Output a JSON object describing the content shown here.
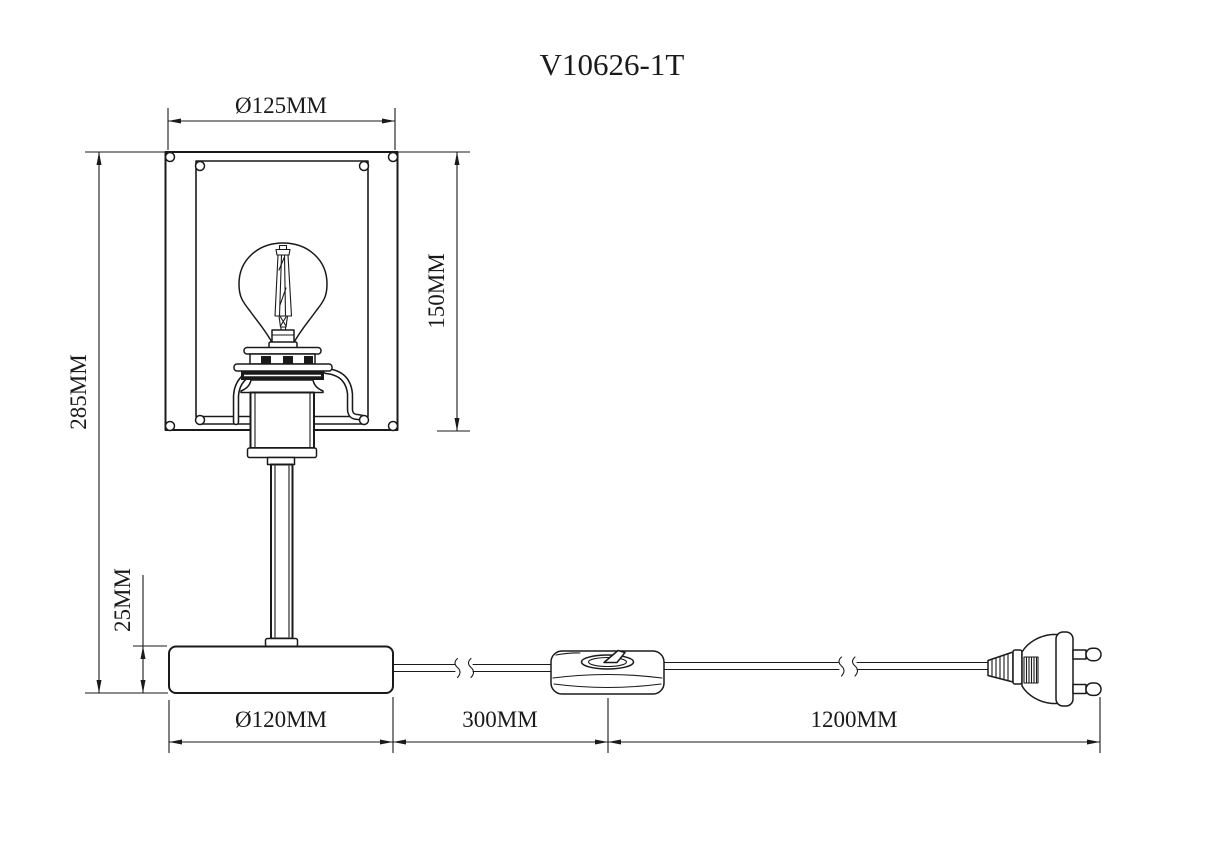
{
  "title": "V10626-1T",
  "drawing": {
    "object": "table-lamp-dimension-drawing",
    "line_color": "#1a1a1a",
    "background_color": "#ffffff"
  },
  "dimensions": {
    "shade_diameter": {
      "label": "Ø125MM",
      "value_mm": 125,
      "axis": "horizontal"
    },
    "shade_height": {
      "label": "150MM",
      "value_mm": 150,
      "axis": "vertical"
    },
    "total_height": {
      "label": "285MM",
      "value_mm": 285,
      "axis": "vertical"
    },
    "base_height": {
      "label": "25MM",
      "value_mm": 25,
      "axis": "vertical"
    },
    "base_diameter": {
      "label": "Ø120MM",
      "value_mm": 120,
      "axis": "horizontal"
    },
    "cord_to_switch": {
      "label": "300MM",
      "value_mm": 300,
      "axis": "horizontal"
    },
    "cord_to_plug": {
      "label": "1200MM",
      "value_mm": 1200,
      "axis": "horizontal"
    }
  }
}
